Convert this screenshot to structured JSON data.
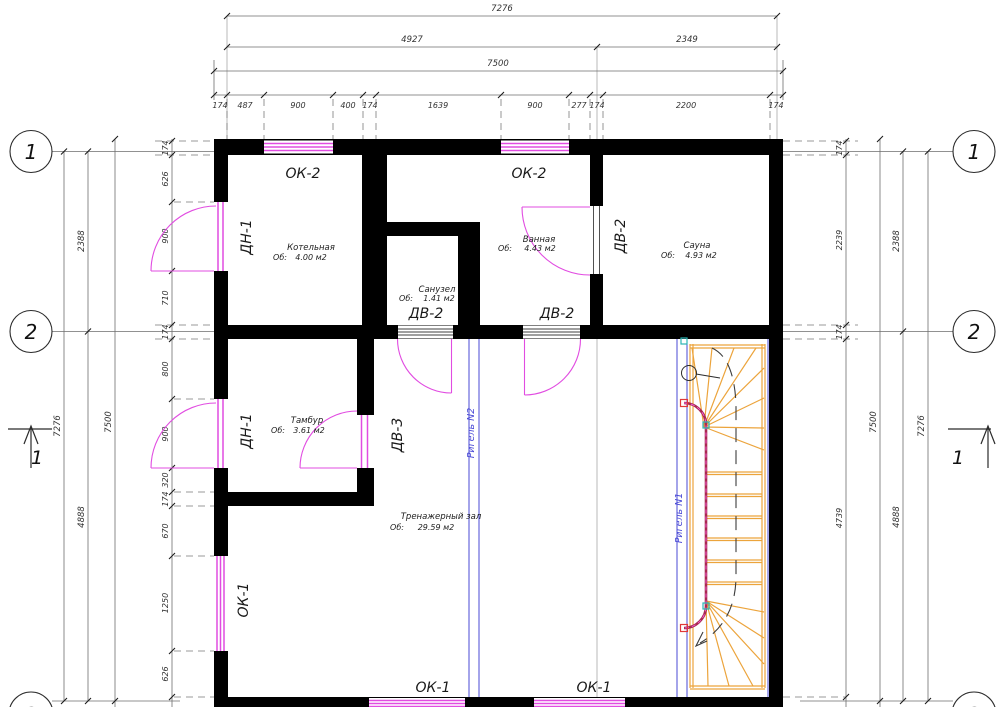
{
  "dims_top": {
    "overall": "7276",
    "left_span": "4927",
    "right_span": "2349",
    "outer": "7500",
    "segments": [
      "174",
      "487",
      "900",
      "400",
      "174",
      "1639",
      "900",
      "277",
      "174",
      "2200",
      "174"
    ]
  },
  "dims_left": {
    "overall": "7276",
    "upper": "2388",
    "lower": "4888",
    "outer": "7500",
    "segments": [
      "174",
      "626",
      "900",
      "710",
      "174",
      "800",
      "900",
      "320",
      "174",
      "670",
      "1250",
      "626"
    ]
  },
  "dims_right": {
    "overall": "7276",
    "upper": "2388",
    "lower": "4888",
    "outer": "7500",
    "segments": [
      "174",
      "2239",
      "174",
      "4739"
    ]
  },
  "axes": {
    "one": "1",
    "two": "2",
    "three": "3"
  },
  "section": {
    "label": "1"
  },
  "openings": {
    "ok1": "ОК-1",
    "ok2": "ОК-2",
    "dn1": "ДН-1",
    "dv2": "ДВ-2",
    "dv3": "ДВ-3"
  },
  "beams": {
    "n1": "Ригель N1",
    "n2": "Ригель N2"
  },
  "rooms": {
    "kotelnaya": {
      "name": "Котельная",
      "prefix": "Об:",
      "area": "4.00 м2"
    },
    "sanuzel": {
      "name": "Санузел",
      "prefix": "Об:",
      "area": "1.41 м2"
    },
    "vannaya": {
      "name": "Ванная",
      "prefix": "Об:",
      "area": "4.43 м2"
    },
    "sauna": {
      "name": "Сауна",
      "prefix": "Об:",
      "area": "4.93 м2"
    },
    "tambur": {
      "name": "Тамбур",
      "prefix": "Об:",
      "area": "3.61 м2"
    },
    "gym": {
      "name": "Тренажерный зал",
      "prefix": "Об:",
      "area": "29.59 м2"
    }
  },
  "colors": {
    "wall": "#000000",
    "opening_magenta": "#e14ce1",
    "stair_orange": "#eca43c",
    "beam_blue": "#4a4ad6",
    "rail_red": "#a82a50"
  }
}
